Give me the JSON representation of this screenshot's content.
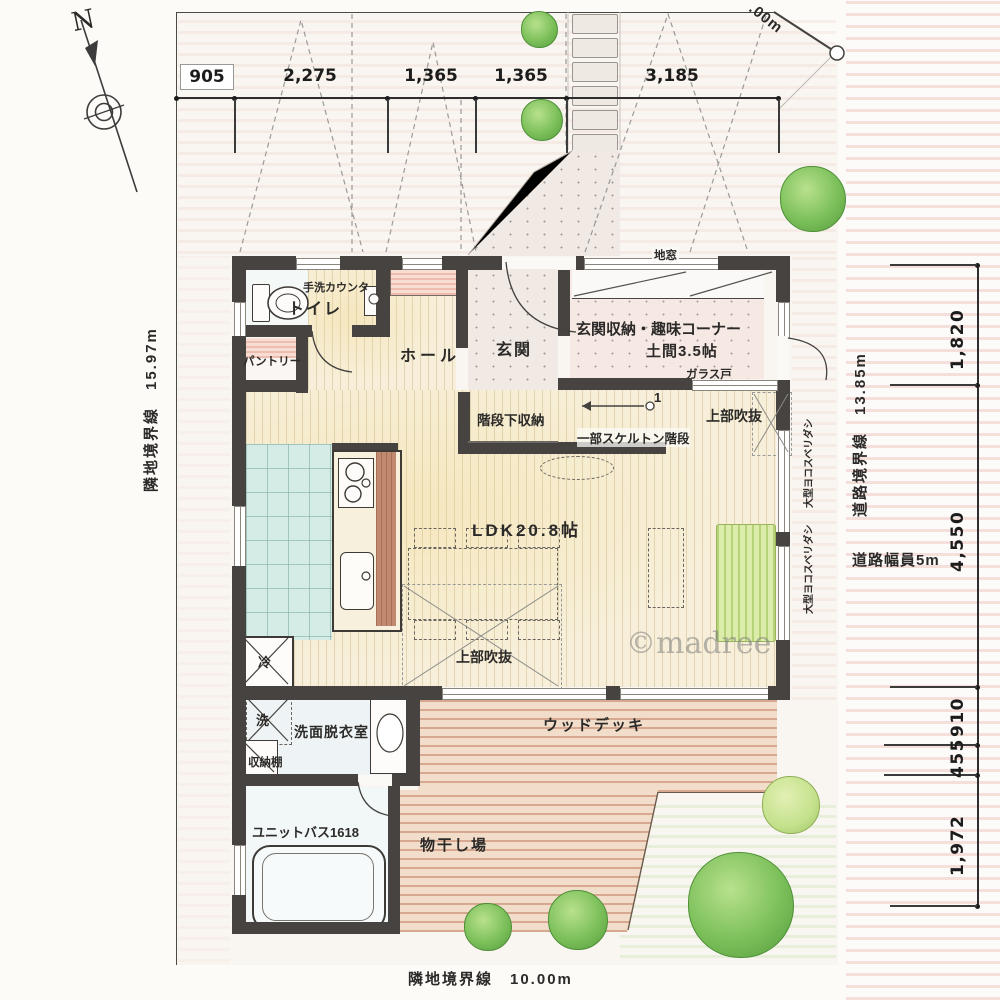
{
  "compass": {
    "north": "N"
  },
  "watermark": "©madree",
  "boundaries": {
    "left": "隣地境界線　15.97m",
    "right": "道路境界線　13.85m",
    "bottom": "隣地境界線　10.00m",
    "road_width": "道路幅員5m",
    "corner_cut": ".00m"
  },
  "dimensions": {
    "top": [
      "905",
      "2,275",
      "1,365",
      "1,365",
      "3,185"
    ],
    "right": [
      "1,820",
      "4,550",
      "910",
      "455",
      "1,972"
    ]
  },
  "rooms": {
    "toilet": "トイレ",
    "hand_wash_counter": "手洗カウンタ",
    "pantry": "パントリー",
    "hall": "ホール",
    "entrance": "玄関",
    "floor_window": "地窓",
    "entrance_storage_line1": "玄関収納・趣味コーナー",
    "entrance_storage_line2": "土間3.5帖",
    "glass_door": "ガラス戸",
    "under_stair_storage": "階段下収納",
    "skeleton_stair": "一部スケルトン階段",
    "void_upper_1": "上部吹抜",
    "void_upper_2": "上部吹抜",
    "ldk": "LDK20.8帖",
    "washroom": "洗面脱衣室",
    "storage_shelf": "収納棚",
    "unit_bath": "ユニットバス1618",
    "drying_area": "物干し場",
    "wood_deck": "ウッドデッキ",
    "window_note_1": "大型ヨコスベリダシ",
    "window_note_2": "大型ヨコスベリダシ"
  },
  "fixtures": {
    "refrigerator": "冷",
    "washer": "洗",
    "stair_number": "1"
  },
  "colors": {
    "wall": "#474340",
    "wood_floor": "#f7efd9",
    "kitchen_tile": "#d4ece5",
    "deck": "#f2ddca",
    "stair_pink": "#f4ded8",
    "tree_green": "#7cc05a",
    "road_hatch": "#e496 8c",
    "counter_brown": "#c18a70"
  }
}
